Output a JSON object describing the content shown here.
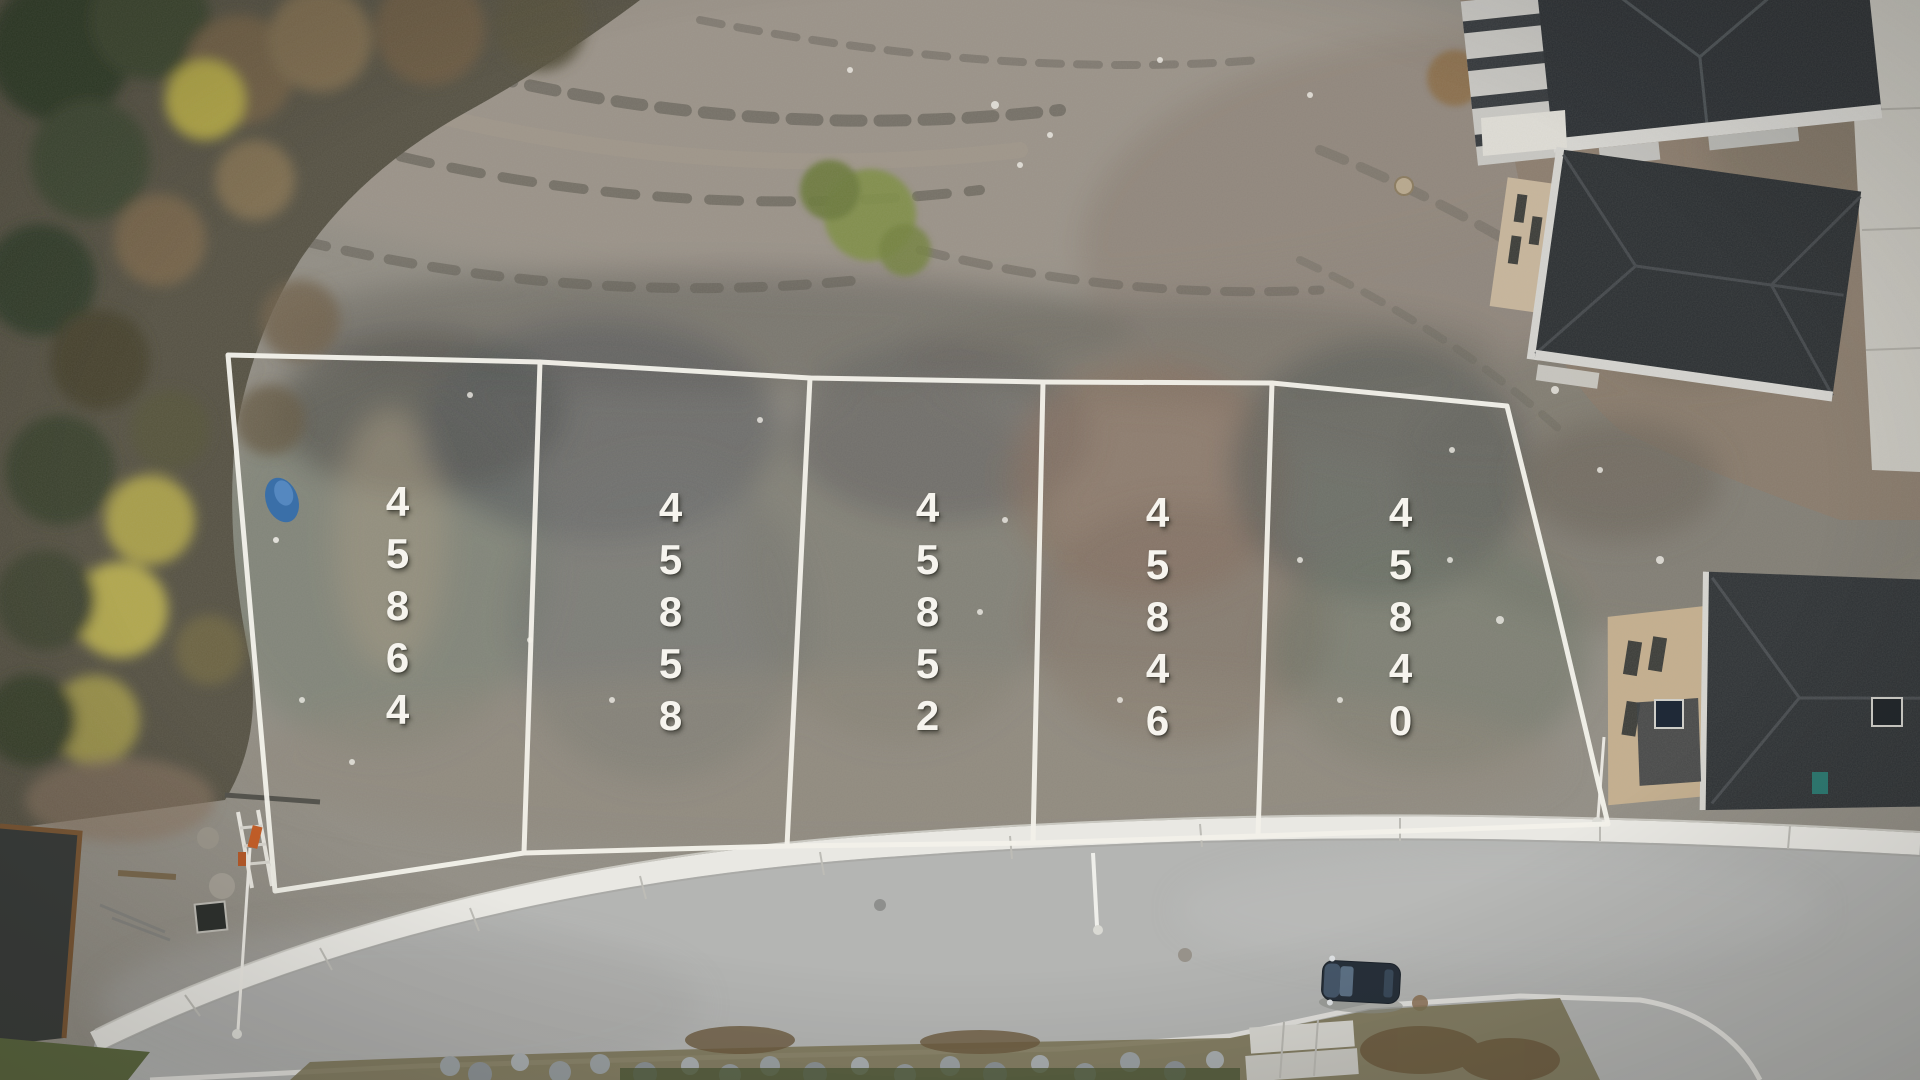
{
  "scene": {
    "type": "aerial-photo",
    "description": "Top-down drone photo of five staked vacant building lots outlined in white survey lines beside a curving residential road, forest on the left, houses under construction on the right.",
    "lots": [
      {
        "number": "45864"
      },
      {
        "number": "45858"
      },
      {
        "number": "45852"
      },
      {
        "number": "45846"
      },
      {
        "number": "45840"
      }
    ],
    "colors": {
      "lot_line": "#f3f1ea",
      "lot_number_text": "#f6f4ee",
      "road_asphalt": "#b4b5b3",
      "sidewalk": "#e9e8e3",
      "gravel_ground": "#928e85",
      "forest_green": "#3c4730",
      "autumn_yellow": "#b0a545",
      "house_roof": "#2c3134",
      "dirt_brown": "#8b7b6a",
      "car_body": "#27303a",
      "tarp_blue": "#3a6fa8",
      "grass_green": "#5c6840"
    }
  }
}
